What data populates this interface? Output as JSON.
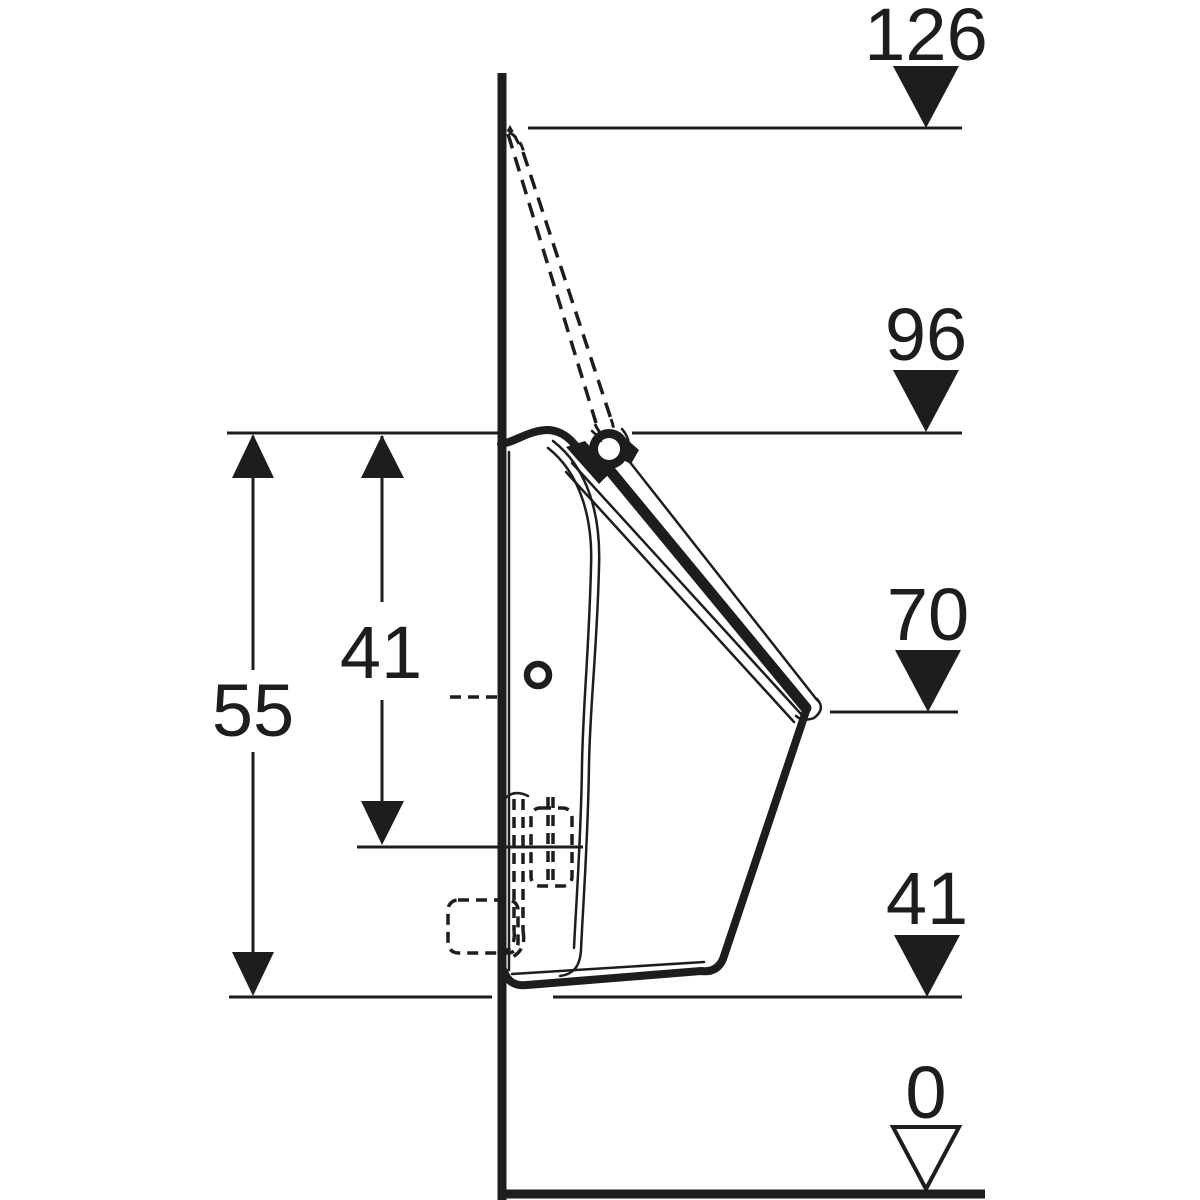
{
  "drawing": {
    "ink_color": "#1d1d1b",
    "background_color": "#ffffff",
    "height_marks": [
      {
        "label": "126"
      },
      {
        "label": "96"
      },
      {
        "label": "70"
      },
      {
        "label": "41"
      },
      {
        "label": "0"
      }
    ],
    "span_dimensions": [
      {
        "label": "55"
      },
      {
        "label": "41"
      }
    ]
  }
}
